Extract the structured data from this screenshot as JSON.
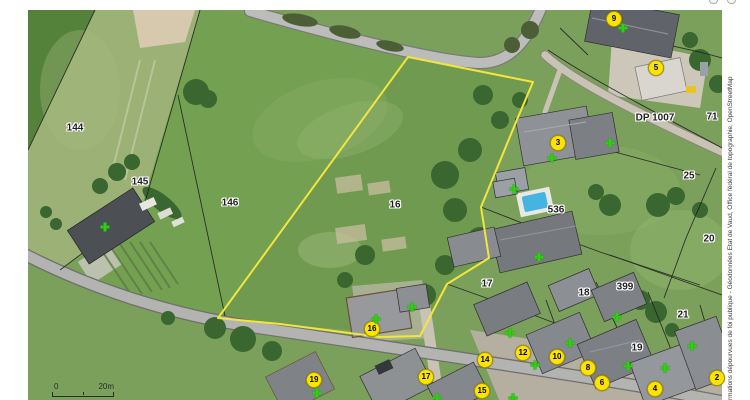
{
  "map_viewer": {
    "attribution_vertical": "rmations dépourvues de foi publique - Géodonnées Etat de Vaud, Office fédéral de topographie, OpenStreetMap",
    "scale_bar": {
      "start": "0",
      "end": "20m"
    },
    "colors": {
      "selected_parcel_outline": "#f2e63c",
      "house_marker_fill": "#fce303",
      "house_marker_border": "#a89a00",
      "address_cross_green": "#2fd012",
      "label_text": "#1f1f1f",
      "label_halo": "#ffffff",
      "pool_blue": "#45b4e0"
    },
    "selected_parcel": {
      "label": "16"
    },
    "parcel_labels": [
      {
        "text": "144",
        "x": 75,
        "y": 128
      },
      {
        "text": "145",
        "x": 140,
        "y": 182
      },
      {
        "text": "146",
        "x": 230,
        "y": 203
      },
      {
        "text": "16",
        "x": 395,
        "y": 205
      },
      {
        "text": "17",
        "x": 487,
        "y": 284
      },
      {
        "text": "536",
        "x": 556,
        "y": 210
      },
      {
        "text": "18",
        "x": 584,
        "y": 293
      },
      {
        "text": "399",
        "x": 625,
        "y": 287
      },
      {
        "text": "21",
        "x": 683,
        "y": 315
      },
      {
        "text": "19",
        "x": 637,
        "y": 348
      },
      {
        "text": "25",
        "x": 689,
        "y": 176
      },
      {
        "text": "20",
        "x": 709,
        "y": 239
      },
      {
        "text": "71",
        "x": 712,
        "y": 117
      },
      {
        "text": "DP 1007",
        "x": 655,
        "y": 118
      }
    ],
    "house_number_markers": [
      {
        "number": "9",
        "x": 614,
        "y": 19
      },
      {
        "number": "5",
        "x": 656,
        "y": 68
      },
      {
        "number": "3",
        "x": 558,
        "y": 143
      },
      {
        "number": "16",
        "x": 372,
        "y": 329
      },
      {
        "number": "19",
        "x": 314,
        "y": 380
      },
      {
        "number": "17",
        "x": 426,
        "y": 377
      },
      {
        "number": "15",
        "x": 482,
        "y": 391
      },
      {
        "number": "14",
        "x": 485,
        "y": 360
      },
      {
        "number": "12",
        "x": 523,
        "y": 353
      },
      {
        "number": "10",
        "x": 557,
        "y": 357
      },
      {
        "number": "8",
        "x": 588,
        "y": 368
      },
      {
        "number": "6",
        "x": 602,
        "y": 383
      },
      {
        "number": "4",
        "x": 655,
        "y": 389
      },
      {
        "number": "2",
        "x": 717,
        "y": 378
      }
    ],
    "address_points": [
      {
        "x": 623,
        "y": 28
      },
      {
        "x": 610,
        "y": 143
      },
      {
        "x": 552,
        "y": 158
      },
      {
        "x": 514,
        "y": 189
      },
      {
        "x": 539,
        "y": 257
      },
      {
        "x": 105,
        "y": 227
      },
      {
        "x": 376,
        "y": 319
      },
      {
        "x": 412,
        "y": 307
      },
      {
        "x": 510,
        "y": 333
      },
      {
        "x": 535,
        "y": 365
      },
      {
        "x": 570,
        "y": 343
      },
      {
        "x": 617,
        "y": 317
      },
      {
        "x": 628,
        "y": 366
      },
      {
        "x": 665,
        "y": 368
      },
      {
        "x": 692,
        "y": 346
      },
      {
        "x": 317,
        "y": 393
      },
      {
        "x": 437,
        "y": 398
      },
      {
        "x": 513,
        "y": 398
      }
    ]
  }
}
